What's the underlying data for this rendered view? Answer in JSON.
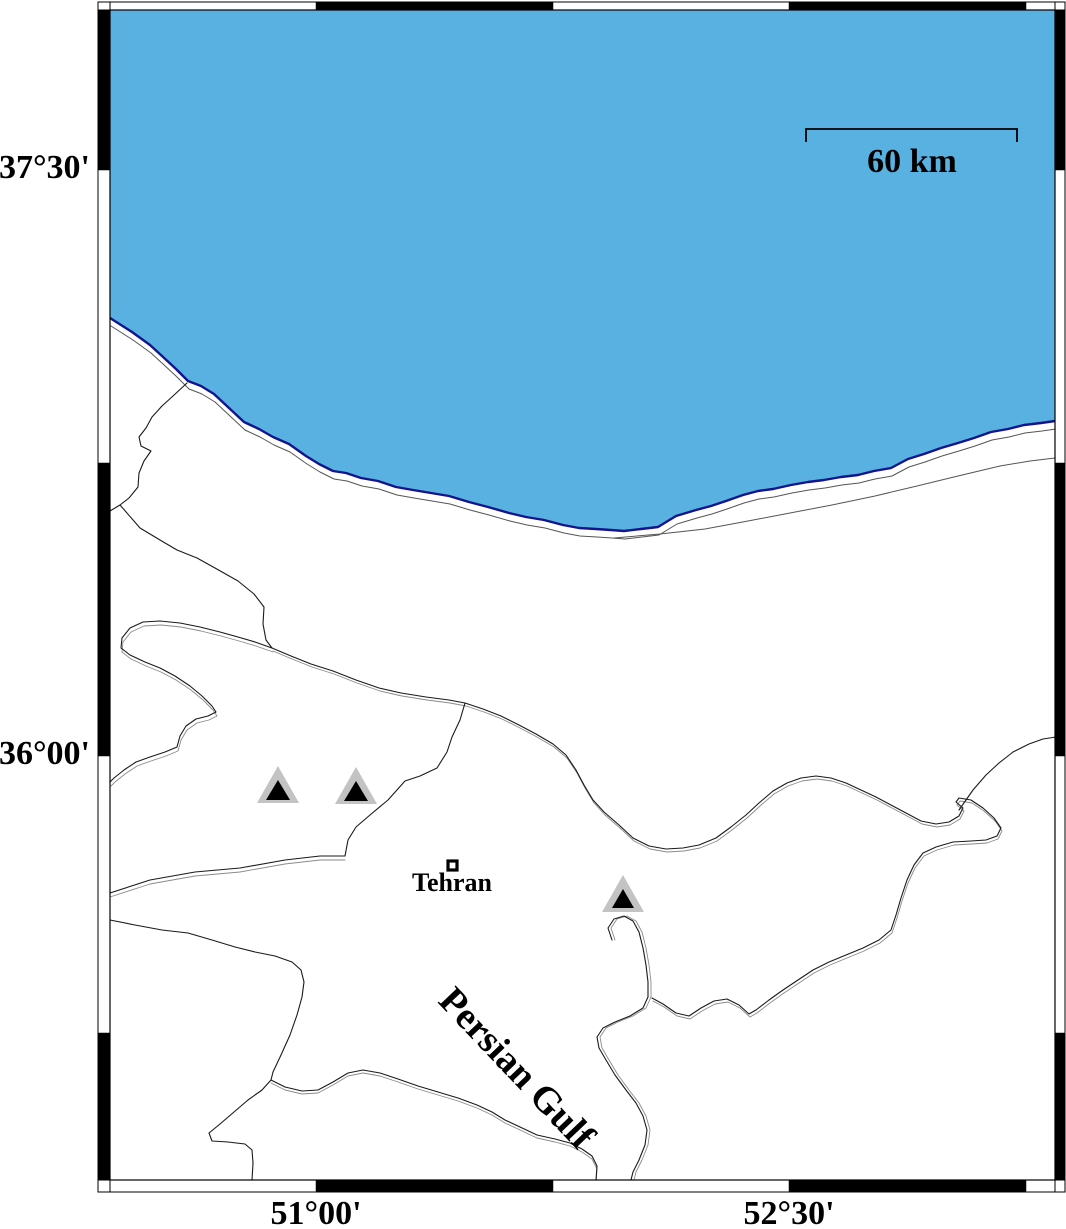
{
  "frame": {
    "lat_ticks": [
      {
        "label": "37°30'"
      },
      {
        "label": "36°00'"
      }
    ],
    "lon_ticks": [
      {
        "label": "51°00'"
      },
      {
        "label": "52°30'"
      }
    ]
  },
  "scale_bar": {
    "label": "60 km"
  },
  "labels": {
    "sea": "Persian Gulf",
    "city": "Tehran"
  },
  "markers": {
    "volcano_triangle_count": 3,
    "city_square_count": 1
  },
  "colors": {
    "water_fill": "#58b1e0",
    "water_outline": "#14148c",
    "coast_thin": "#666666",
    "border_line": "#1a1a1a",
    "border_shadow": "#8a8a8a",
    "triangle_halo": "#c3c3c3",
    "triangle_fill": "#000000",
    "frame_black": "#000000",
    "frame_white": "#ffffff",
    "background": "#ffffff"
  }
}
